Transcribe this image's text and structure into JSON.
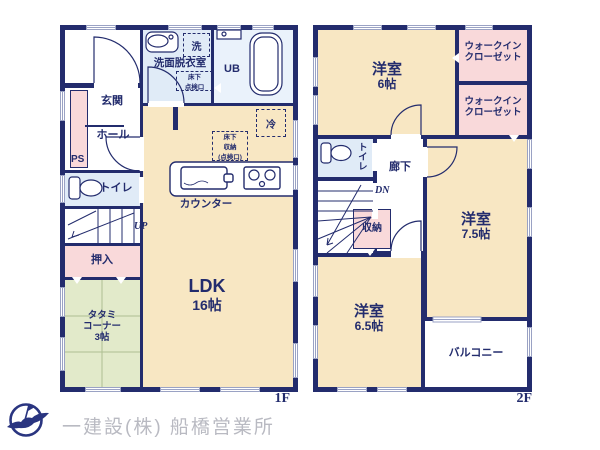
{
  "colors": {
    "wall": "#232c6d",
    "room_cream": "#f8e7c3",
    "room_wet_blue": "#e0ebf7",
    "room_bath": "#eaf2fb",
    "room_pink": "#f9d9da",
    "room_tatami": "#e2eaca",
    "window_line": "#9aa2c4",
    "text": "#232c6d",
    "footer_text": "#b9bac2"
  },
  "floor1": {
    "label": "1F",
    "washroom": "洗面脱衣室",
    "washer": "洗",
    "ub": "UB",
    "underfloor_hatch": {
      "line1": "床下",
      "line2": "点検口"
    },
    "fridge": "冷",
    "underfloor_storage": {
      "line1": "床下",
      "line2": "収納",
      "line3": "(点検口)"
    },
    "entrance": "玄関",
    "hall": "ホール",
    "ps": "PS",
    "toilet": "トイレ",
    "stairs_direction": "UP",
    "closet": "押入",
    "tatami": {
      "line1": "タタミ",
      "line2": "コーナー",
      "size": "3帖"
    },
    "ldk": {
      "name": "LDK",
      "size": "16帖"
    },
    "kitchen_counter": "カウンター"
  },
  "floor2": {
    "label": "2F",
    "bedroom6": {
      "name": "洋室",
      "size": "6帖"
    },
    "walk_in_closet": {
      "line1": "ウォークイン",
      "line2": "クローゼット"
    },
    "toilet": "トイレ",
    "hallway": "廊下",
    "stairs_direction": "DN",
    "closet": "収納",
    "bedroom75": {
      "name": "洋室",
      "size": "7.5帖"
    },
    "bedroom65": {
      "name": "洋室",
      "size": "6.5帖"
    },
    "balcony": "バルコニー"
  },
  "footer": {
    "company": "一建設(株) 船橋営業所"
  }
}
